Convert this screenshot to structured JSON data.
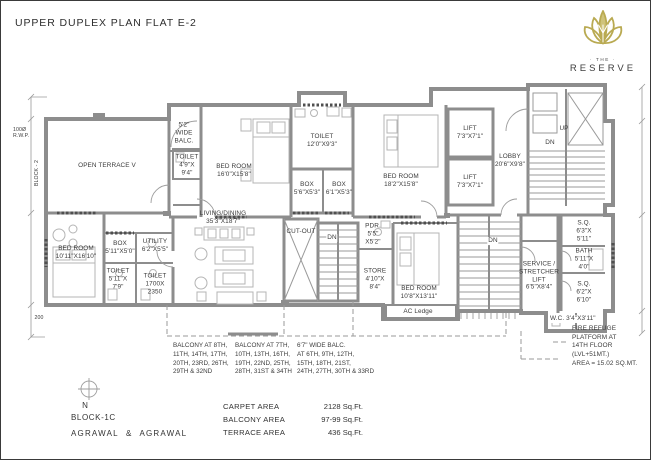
{
  "title": "UPPER DUPLEX PLAN FLAT E-2",
  "brand": {
    "the": "· THE ·",
    "name": "RESERVE",
    "color": "#b9aa52"
  },
  "rooms": {
    "rwp": "100Ø\nR.W.P.",
    "block2": "BLOCK - 2",
    "dim200": "200",
    "open_terrace": "OPEN TERRACE V",
    "wide_balc": "5'2\"\nWIDE\nBALC.",
    "toilet49": "TOILET\n4'9\"X\n9'4\"",
    "bedroom16": "BED ROOM\n16'0\"X15'8\"",
    "toilet12": "TOILET\n12'0\"X9'3\"",
    "box56": "BOX\n5'6\"X5'3\"",
    "box61": "BOX\n6'1\"X5'3\"",
    "bedroom18": "BED ROOM\n18'2\"X15'8\"",
    "lift1": "LIFT\n7'3\"X7'1\"",
    "lift2": "LIFT\n7'3\"X7'1\"",
    "lobby": "LOBBY\n20'6\"X9'8\"",
    "up": "UP",
    "dn_top": "DN",
    "living": "LIVING/DINING\n35'3\"X18'7\"",
    "utility": "UTILITY\n6'2\"X5'5\"",
    "box511": "BOX\n5'11\"X5'0\"",
    "bedroom1011": "BED ROOM\n10'11\"X16'10\"",
    "toilet511": "TOILET\n5'11\"X\n7'9\"",
    "toilet1700": "TOILET\n1700X\n2350",
    "cutout": "CUT-OUT",
    "dn_mid": "DN",
    "pdr": "PDR.\n5'5\"\nX5'2\"",
    "store": "STORE\n4'10\"X\n8'4\"",
    "bedroom108": "BED ROOM\n10'8\"X13'11\"",
    "ac_ledge": "AC Ledge",
    "dn_right": "DN",
    "sq63": "S.Q.\n6'3\"X\n5'11\"",
    "bath": "BATH\n5'11\"X\n4'0\"",
    "service_lift": "SERVICE /\nSTRETCHER\nLIFT\n6'5\"X8'4\"",
    "sq62": "S.Q.\n6'2\"X\n6'10\"",
    "wc": "W.C. 3'4\"X3'11\"",
    "fire_refuge": "FIRE REFUGE\nPLATFORM AT\n14TH FLOOR\n(LVL+51MT.)\nAREA = 15.02 SQ.MT."
  },
  "notes": [
    {
      "text": "BALCONY AT 8TH,\n11TH, 14TH, 17TH,\n20TH, 23RD, 26TH,\n29TH & 32ND"
    },
    {
      "text": "BALCONY AT 7TH,\n10TH, 13TH, 16TH,\n19TH, 22ND, 25TH,\n28TH, 31ST & 34TH"
    },
    {
      "text": "6'7\" WIDE BALC.\nAT 6TH, 9TH, 12TH,\n15TH, 18TH, 21ST,\n24TH, 27TH, 30TH & 33RD"
    }
  ],
  "footer": {
    "north": "N",
    "block": "BLOCK-1C",
    "firm": "AGRAWAL & AGRAWAL",
    "areas": [
      {
        "label": "CARPET AREA",
        "value": "2128 Sq.Ft."
      },
      {
        "label": "BALCONY AREA",
        "value": "97-99 Sq.Ft."
      },
      {
        "label": "TERRACE AREA",
        "value": "436 Sq.Ft."
      }
    ]
  }
}
